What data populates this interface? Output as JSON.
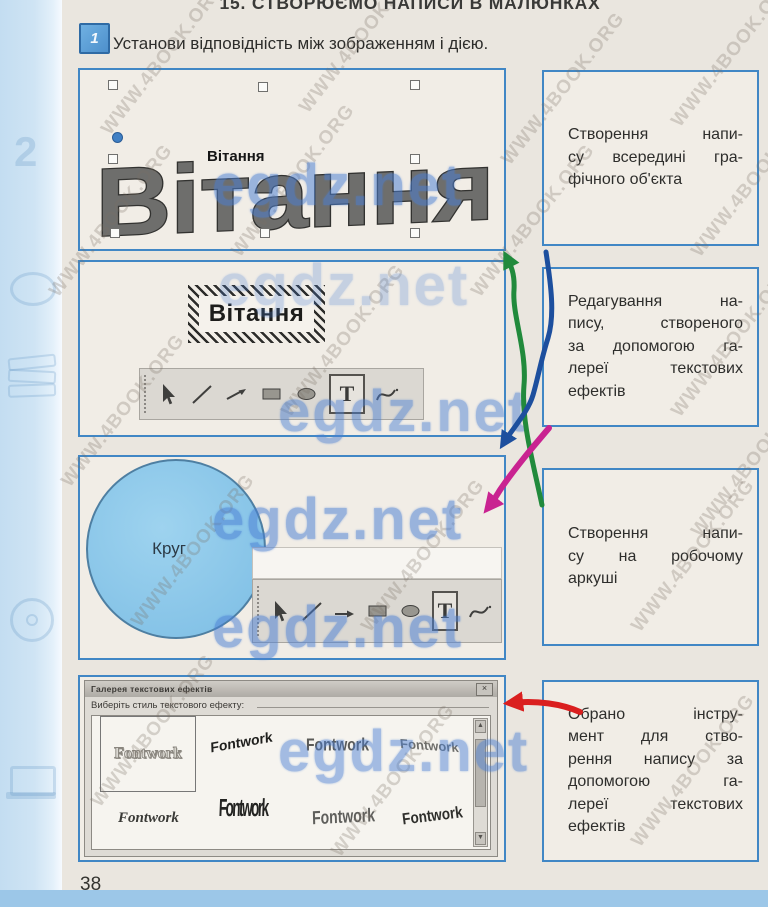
{
  "page": {
    "title": "15. СТВОРЮЄМО НАПИСИ В МАЛЮНКАХ",
    "task_number": "1",
    "task_instruction": "Установи відповідність між зображенням і дією.",
    "page_number": "38"
  },
  "decorations": {
    "numeral": "2"
  },
  "left_column": {
    "box1": {
      "wordart_text": "Вітання",
      "overlay_text": "Вітання"
    },
    "box2": {
      "frame_text": "Вітання"
    },
    "box3": {
      "circle_label": "Круг"
    },
    "box4": {
      "dialog_title": "Галерея текстових ефектів",
      "close_glyph": "×",
      "instruction": "Виберіть стиль текстового ефекту:",
      "scroll_up_glyph": "▲",
      "scroll_down_glyph": "▼",
      "items": [
        "Fontwork",
        "Fontwork",
        "Fontwork",
        "Fontwork",
        "Fontwork",
        "Fontwork",
        "Fontwork",
        "Fontwork"
      ]
    }
  },
  "toolbar": {
    "text_tool_label": "T"
  },
  "right_column": {
    "boxes": [
      {
        "lines": [
          "Створення напи-",
          "су всередині гра-",
          "фічного об'єкта"
        ]
      },
      {
        "lines": [
          "Редагування на-",
          "пису, створеного",
          "за допомогою га-",
          "лереї текстових",
          "ефектів"
        ]
      },
      {
        "lines": [
          "Створення напи-",
          "су на робочому",
          "аркуші"
        ]
      },
      {
        "lines": [
          "Обрано інстру-",
          "мент для ство-",
          "рення напису за",
          "допомогою га-",
          "лереї текстових",
          "ефектів"
        ]
      }
    ]
  },
  "annotations": {
    "watermark": "egdz.net",
    "site_watermark": "WWW.4BOOK.ORG"
  },
  "colors": {
    "box_border": "#4187c5",
    "arrow_green": "#218a3c",
    "arrow_blue": "#1d4f9e",
    "arrow_magenta": "#c92391",
    "arrow_red": "#da1f1f",
    "circle_fill": "#85c3e8",
    "watermark_blue": "#4a7fd4"
  }
}
